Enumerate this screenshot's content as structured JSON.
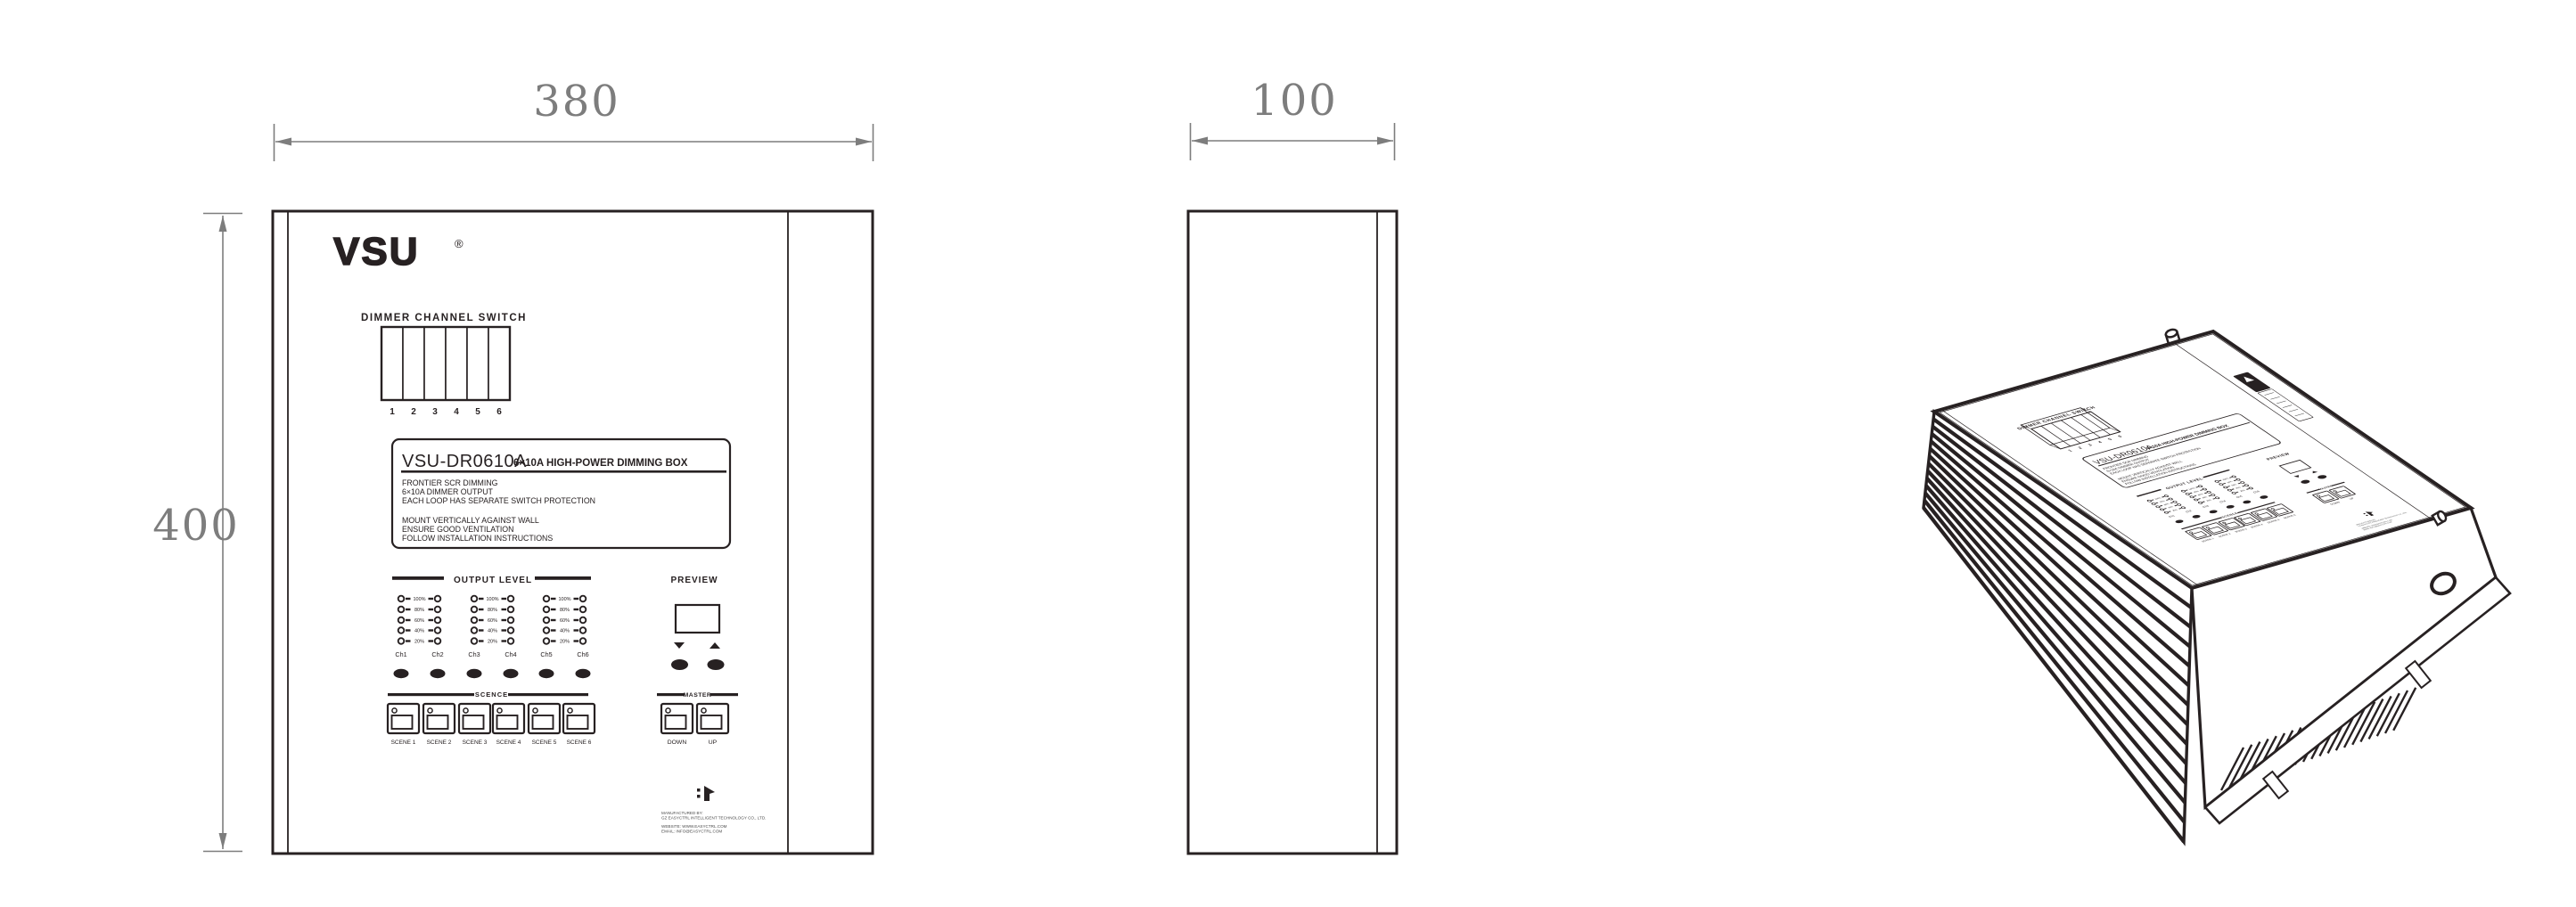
{
  "palette": {
    "ink": "#272122",
    "dim_gray": "#7d7d7d",
    "page_bg": "#ffffff",
    "fine_print": "#4a4a4a"
  },
  "dimensions": {
    "front_width": "380",
    "front_height": "400",
    "side_width": "100"
  },
  "brand": {
    "logo": "VSU",
    "registered": "®"
  },
  "front_panel": {
    "dimmer_switch": {
      "title": "DIMMER CHANNEL SWITCH",
      "channels": [
        "1",
        "2",
        "3",
        "4",
        "5",
        "6"
      ]
    },
    "spec_label": {
      "model": "VSU-DR0610A",
      "subtitle": "6×10A HIGH-POWER DIMMING BOX",
      "features": [
        "FRONTIER SCR DIMMING",
        "6×10A DIMMER OUTPUT",
        "EACH LOOP HAS SEPARATE SWITCH PROTECTION"
      ],
      "instructions": [
        "MOUNT VERTICALLY AGAINST WALL",
        "ENSURE GOOD VENTILATION",
        "FOLLOW INSTALLATION INSTRUCTIONS"
      ]
    },
    "output_level": {
      "title": "OUTPUT LEVEL",
      "percent_labels": [
        "100%",
        "80%",
        "60%",
        "40%",
        "20%"
      ],
      "channel_labels": [
        "Ch1",
        "Ch2",
        "Ch3",
        "Ch4",
        "Ch5",
        "Ch6"
      ]
    },
    "scene": {
      "title": "SCENCE",
      "buttons": [
        "SCENE 1",
        "SCENE 2",
        "SCENE 3",
        "SCENE 4",
        "SCENE 5",
        "SCENE 6"
      ]
    },
    "preview": {
      "title": "PREVIEW"
    },
    "master": {
      "title": "MASTER",
      "buttons": [
        "DOWN",
        "UP"
      ]
    },
    "manufacturer": {
      "lines": [
        "MANUFACTURED BY:",
        "GZ EASYCTRL INTELLIGENT TECHNOLOGY CO., LTD.",
        "WEBSITE: WWW.EASYCTRL.COM",
        "EMAIL: INFO@EASYCTRL.COM"
      ]
    }
  }
}
